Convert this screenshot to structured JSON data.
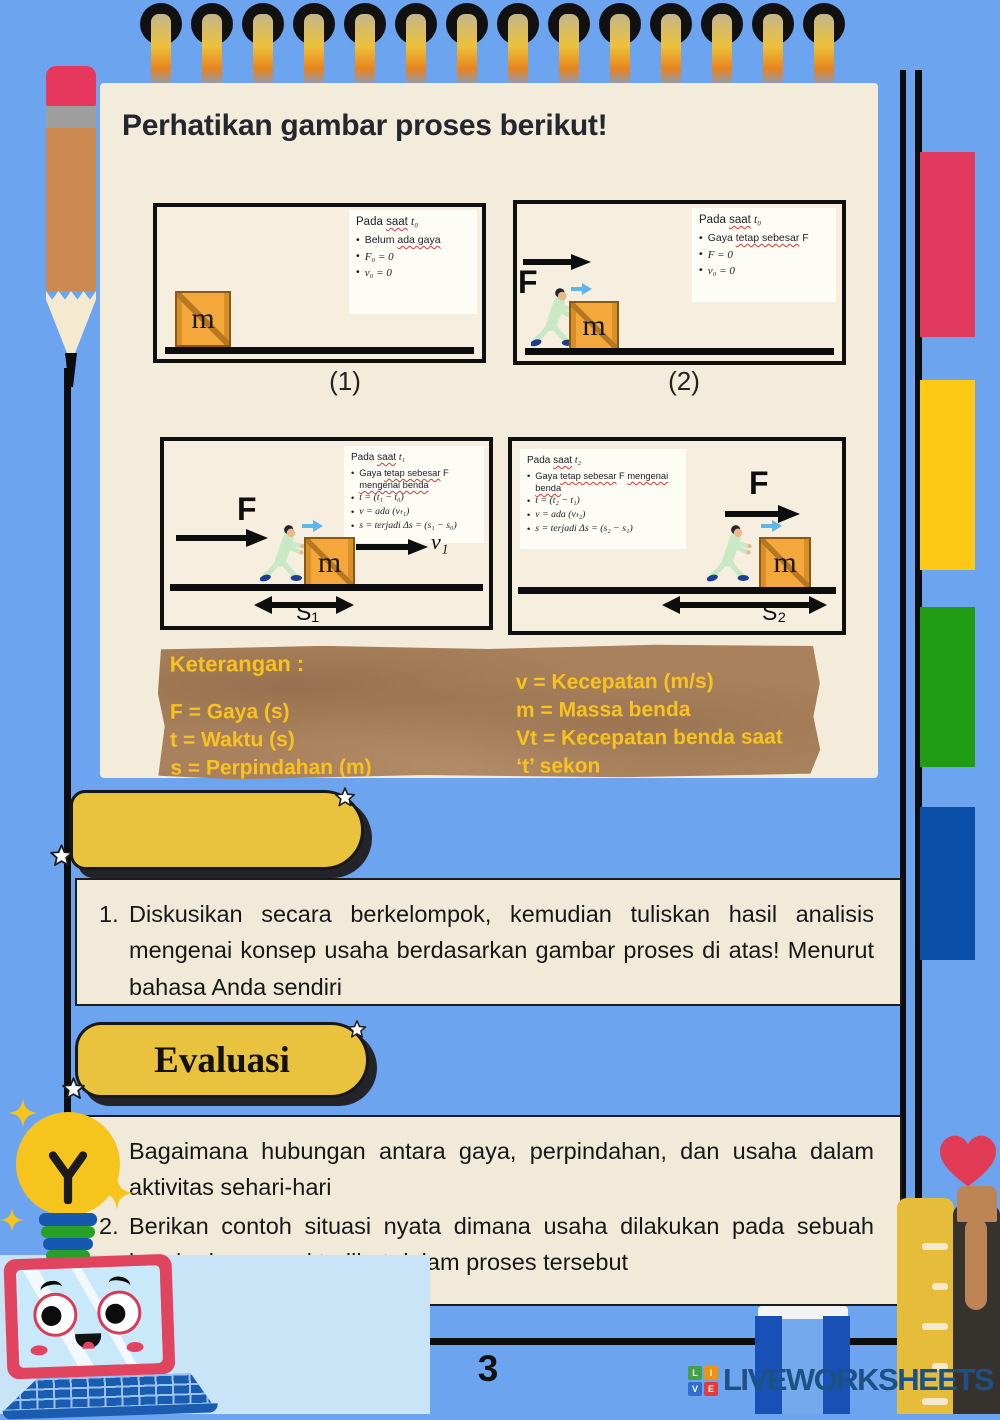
{
  "title": "Perhatikan gambar proses berikut!",
  "figures": [
    {
      "label": "(1)",
      "crate": "m",
      "info": {
        "pre": "Pada",
        "wavy": "saat",
        "sub": "t₀"
      },
      "bullets": {
        "b1_pre": "Belum",
        "b1_wavy": "ada gaya",
        "b2": "F₀ = 0",
        "b3": "v₀ = 0"
      }
    },
    {
      "label": "(2)",
      "crate": "m",
      "force": "F",
      "info": {
        "pre": "Pada",
        "wavy": "saat",
        "sub": "t₀"
      },
      "bullets": {
        "b1_pre": "Gaya",
        "b1_wavy": "tetap sebesar",
        "b1_mid": "F",
        "b2": "F = 0",
        "b3": "v₀ = 0"
      }
    },
    {
      "crate": "m",
      "force": "F",
      "velocity": "v₁",
      "distance": "S₁",
      "info": {
        "pre": "Pada",
        "wavy": "saat",
        "sub": "t₁"
      },
      "bullets": {
        "b1_pre": "Gaya",
        "b1_wavy": "tetap sebesar",
        "b1_mid": "F",
        "b1_wavy2": "mengenai benda",
        "b2": "t = (t₁ − t₀)",
        "b3": "v = ada (vₜ₁)",
        "b4": "s = terjadi Δs = (s₁ − s₀)"
      }
    },
    {
      "crate": "m",
      "force": "F",
      "distance": "S₂",
      "info": {
        "pre": "Pada",
        "wavy": "saat",
        "sub": "t₂"
      },
      "bullets": {
        "b1_pre": "Gaya",
        "b1_wavy": "tetap sebesar",
        "b1_mid": "F",
        "b1_wavy2": "mengenai benda",
        "b2": "t = (t₂ − t₁)",
        "b3": "v = ada (vₜ₂)",
        "b4": "s = terjadi Δs = (s₂ − s₁)"
      }
    }
  ],
  "keterangan": {
    "heading": "Keterangan :",
    "left": [
      "F = Gaya (s)",
      "t = Waktu (s)",
      "s = Perpindahan (m)"
    ],
    "right": [
      "v =  Kecepatan (m/s)",
      "m = Massa benda",
      "Vt = Kecepatan benda saat",
      "‘t’ sekon"
    ]
  },
  "discussion": {
    "items": [
      {
        "num": "1.",
        "text": "Diskusikan secara berkelompok, kemudian tuliskan hasil analisis mengenai konsep usaha berdasarkan gambar proses di atas! Menurut bahasa Anda sendiri"
      }
    ]
  },
  "evaluasi": {
    "title": "Evaluasi",
    "items": [
      {
        "num": "1.",
        "text": "Bagaimana hubungan antara gaya, perpindahan, dan usaha dalam aktivitas sehari-hari"
      },
      {
        "num": "2.",
        "text": "Berikan contoh situasi nyata dimana usaha dilakukan pada sebuah benda dan energi terlibat dalam proses tersebut"
      }
    ]
  },
  "footer": {
    "page_number": "3",
    "brand": "LIVEWORKSHEETS",
    "logo": [
      "L",
      "I",
      "V",
      "E"
    ]
  },
  "colors": {
    "background": "#6da4ef",
    "panel": "#f3ecda",
    "banner_yellow": "#e9c33e",
    "keterangan_bg": "#a9815c",
    "keterangan_text": "#f8c31e",
    "tab_red": "#e03a5e",
    "tab_yellow": "#fdc915",
    "tab_green": "#1f9c13",
    "tab_blue": "#0b4fa8",
    "brand_navy": "#1d5186"
  }
}
